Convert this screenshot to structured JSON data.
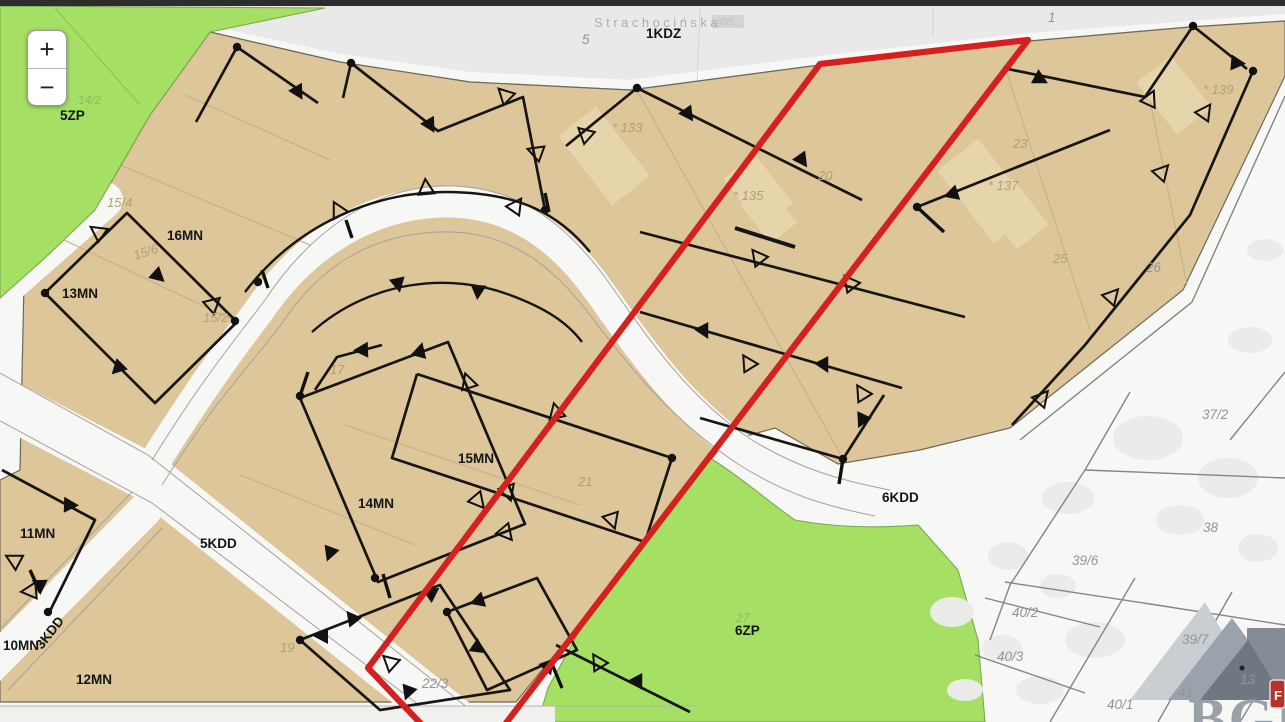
{
  "app": {
    "type": "zoning-map-viewer"
  },
  "controls": {
    "zoom_in_label": "+",
    "zoom_out_label": "−"
  },
  "street": {
    "name": "Strachocińska",
    "badge": "455"
  },
  "watermark": {
    "text": "BGM",
    "badge_letter": "F"
  },
  "colors": {
    "zone_residential_fill": "#dcc69a",
    "zone_green_fill": "#a5e065",
    "selection_outline": "#d42120",
    "road_fill": "#f6f6f4",
    "marker_line": "#161616",
    "top_bar": "#2d2d2d",
    "building_fill": "#e6d4aa"
  },
  "map": {
    "zone_codes": [
      "1KDZ",
      "5ZP",
      "16MN",
      "13MN",
      "15MN",
      "14MN",
      "11MN",
      "10MN",
      "12MN",
      "3KDD",
      "5KDD",
      "6KDD",
      "6ZP"
    ],
    "labels": [
      {
        "text": "Strachocińska",
        "x": 594,
        "y": 27,
        "t": "st"
      },
      {
        "text": "1KDZ",
        "x": 646,
        "y": 38,
        "t": "z"
      },
      {
        "text": "5",
        "x": 582,
        "y": 44,
        "t": "fw"
      },
      {
        "text": "1",
        "x": 1048,
        "y": 22,
        "t": "fw"
      },
      {
        "text": "5ZP",
        "x": 60,
        "y": 120,
        "t": "z"
      },
      {
        "text": "14/2",
        "x": 78,
        "y": 104,
        "t": "fg"
      },
      {
        "text": "16MN",
        "x": 167,
        "y": 240,
        "t": "z"
      },
      {
        "text": "15/4",
        "x": 107,
        "y": 207,
        "t": "ft"
      },
      {
        "text": "15/6",
        "x": 135,
        "y": 260,
        "t": "ft",
        "r": -18
      },
      {
        "text": "15/2",
        "x": 203,
        "y": 322,
        "t": "ft"
      },
      {
        "text": "13MN",
        "x": 62,
        "y": 298,
        "t": "z"
      },
      {
        "text": "17",
        "x": 330,
        "y": 374,
        "t": "ft"
      },
      {
        "text": "15MN",
        "x": 458,
        "y": 463,
        "t": "z"
      },
      {
        "text": "14MN",
        "x": 358,
        "y": 508,
        "t": "z"
      },
      {
        "text": "21",
        "x": 578,
        "y": 486,
        "t": "ft"
      },
      {
        "text": "11MN",
        "x": 20,
        "y": 538,
        "t": "z"
      },
      {
        "text": "5KDD",
        "x": 200,
        "y": 548,
        "t": "z"
      },
      {
        "text": "3KDD",
        "x": 42,
        "y": 650,
        "t": "z",
        "r": -52
      },
      {
        "text": "10MN",
        "x": 3,
        "y": 650,
        "t": "z"
      },
      {
        "text": "12MN",
        "x": 76,
        "y": 684,
        "t": "z"
      },
      {
        "text": "19",
        "x": 280,
        "y": 652,
        "t": "ft"
      },
      {
        "text": "22/3",
        "x": 422,
        "y": 688,
        "t": "fw"
      },
      {
        "text": "20",
        "x": 818,
        "y": 180,
        "t": "ft"
      },
      {
        "text": "23",
        "x": 1013,
        "y": 148,
        "t": "ft"
      },
      {
        "text": "25",
        "x": 1053,
        "y": 263,
        "t": "ft"
      },
      {
        "text": "26",
        "x": 1146,
        "y": 272,
        "t": "fw"
      },
      {
        "text": "* 133",
        "x": 612,
        "y": 132,
        "t": "ft"
      },
      {
        "text": "* 135",
        "x": 733,
        "y": 200,
        "t": "ft"
      },
      {
        "text": "* 137",
        "x": 988,
        "y": 190,
        "t": "ft"
      },
      {
        "text": "* 139",
        "x": 1203,
        "y": 94,
        "t": "ft"
      },
      {
        "text": "6KDD",
        "x": 882,
        "y": 502,
        "t": "z"
      },
      {
        "text": "6ZP",
        "x": 735,
        "y": 635,
        "t": "z"
      },
      {
        "text": "27",
        "x": 736,
        "y": 622,
        "t": "fg"
      },
      {
        "text": "37/2",
        "x": 1202,
        "y": 419,
        "t": "fw"
      },
      {
        "text": "38",
        "x": 1203,
        "y": 532,
        "t": "fw"
      },
      {
        "text": "39/6",
        "x": 1072,
        "y": 565,
        "t": "fw"
      },
      {
        "text": "40/2",
        "x": 1012,
        "y": 617,
        "t": "fw"
      },
      {
        "text": "40/3",
        "x": 997,
        "y": 661,
        "t": "fw"
      },
      {
        "text": "39/7",
        "x": 1182,
        "y": 644,
        "t": "fw"
      },
      {
        "text": "40/1",
        "x": 1107,
        "y": 709,
        "t": "fw"
      },
      {
        "text": "41",
        "x": 1178,
        "y": 697,
        "t": "fw"
      },
      {
        "text": "13",
        "x": 1240,
        "y": 684,
        "t": "fw"
      }
    ]
  }
}
